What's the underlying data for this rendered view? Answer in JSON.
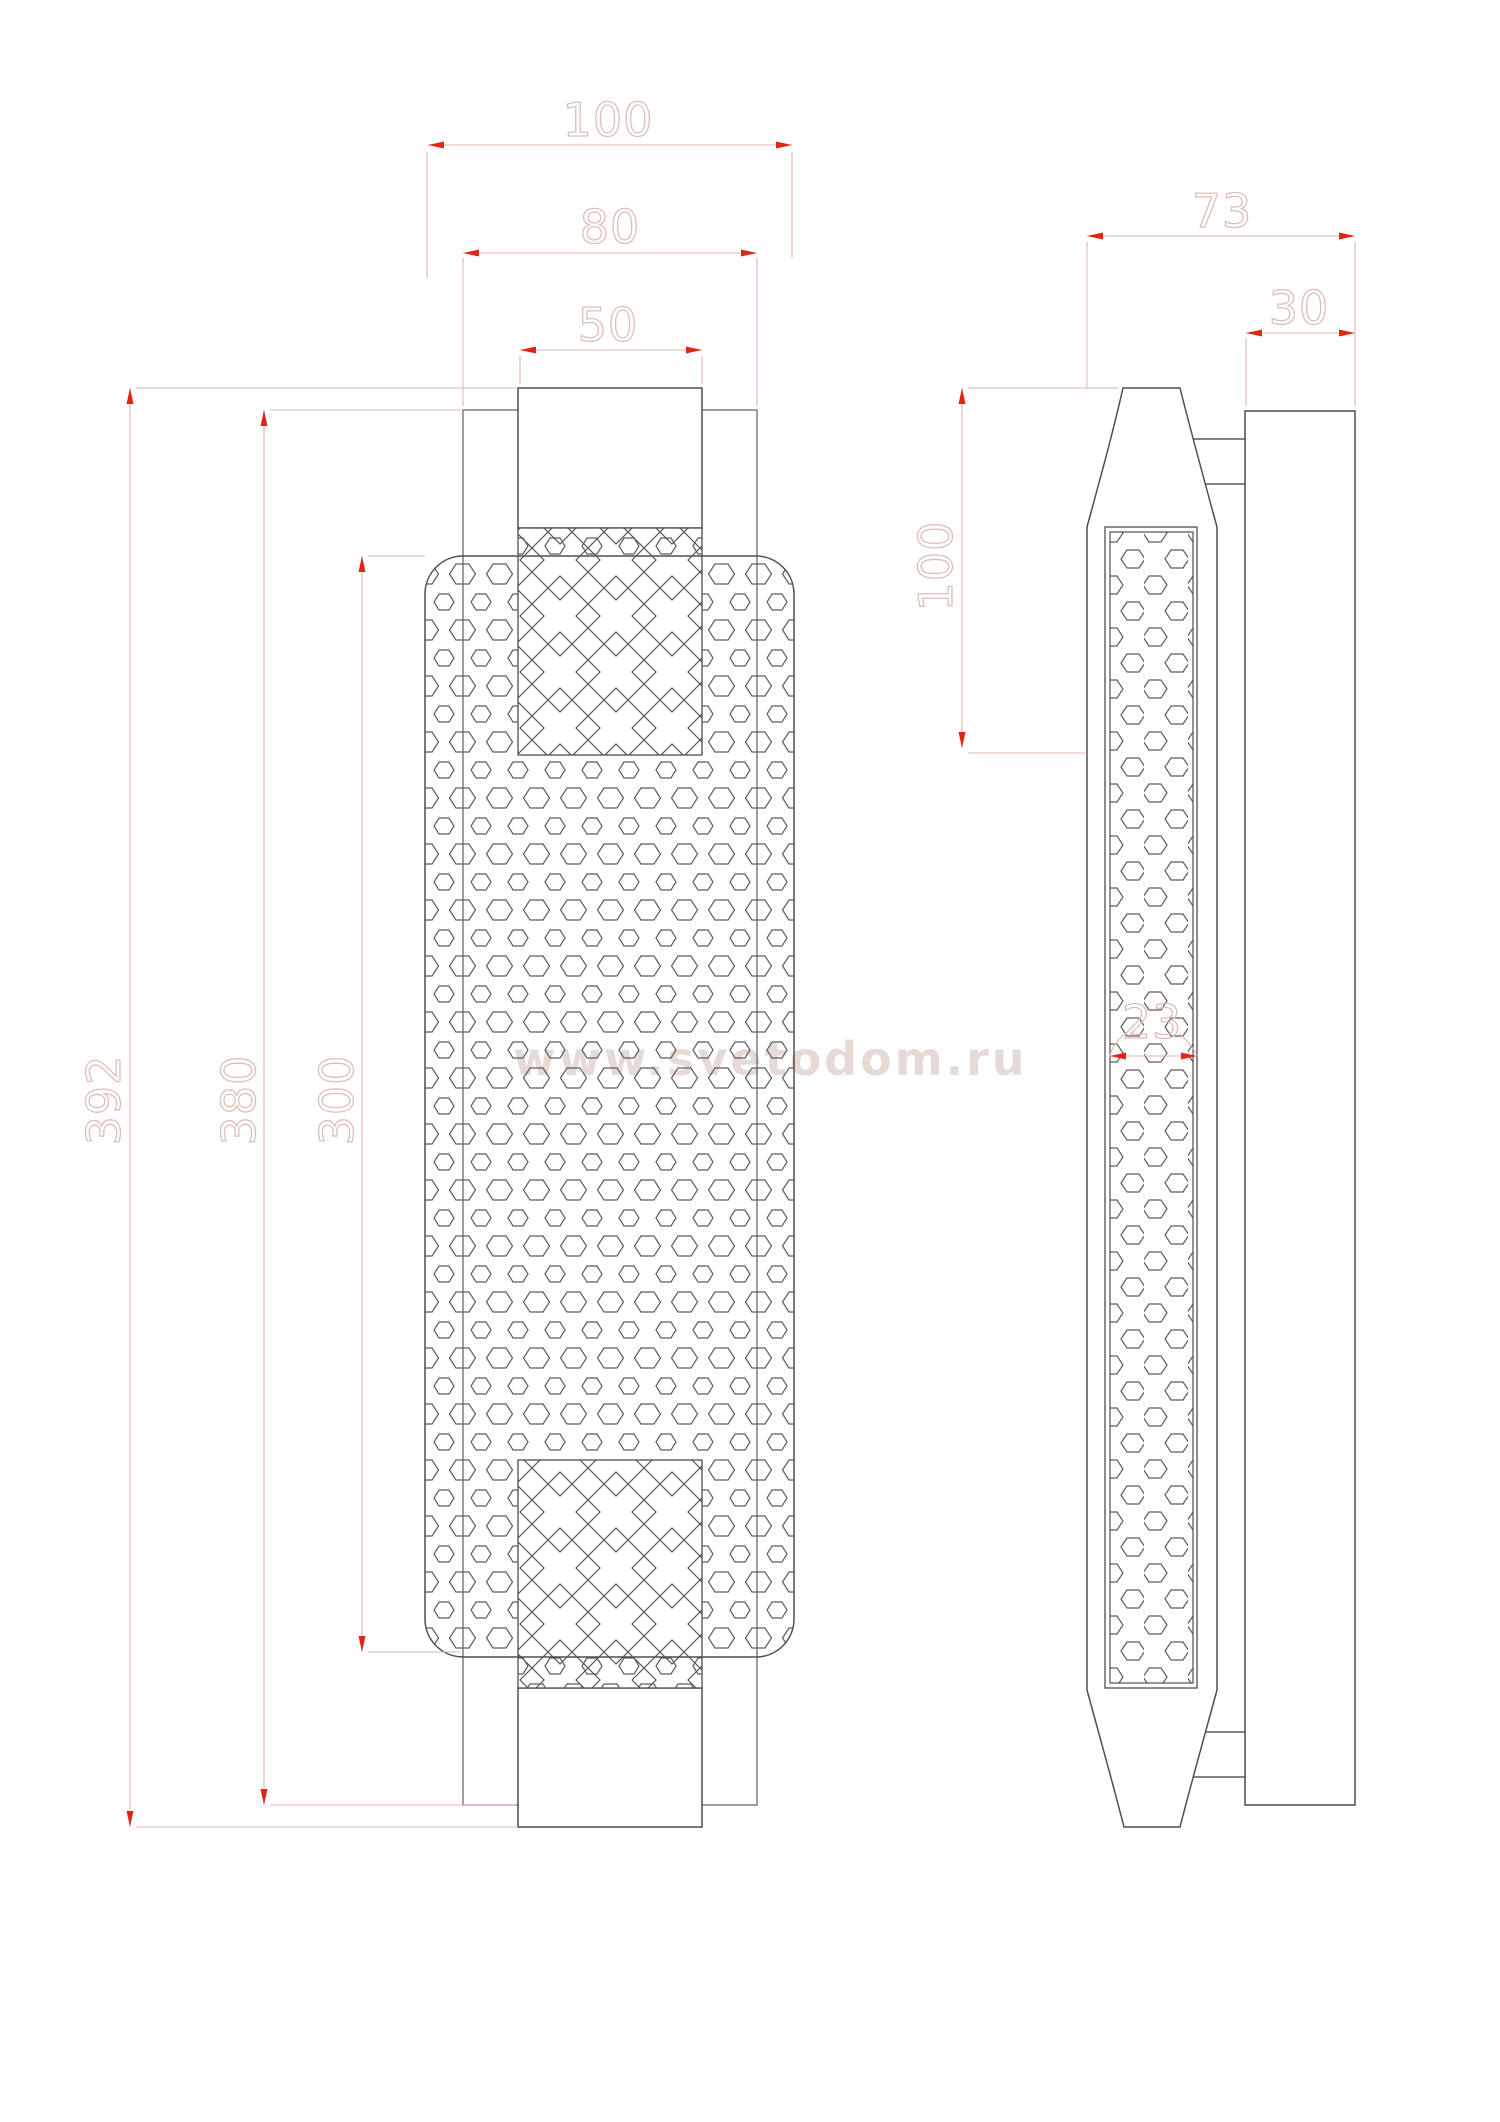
{
  "watermark": "www.svetodom.ru",
  "dimensions": {
    "front": {
      "width_overall": "100",
      "width_backplate": "80",
      "width_cap": "50",
      "height_overall": "392",
      "height_backplate": "380",
      "height_glass": "300"
    },
    "side": {
      "depth_overall": "73",
      "wallplate_depth": "30",
      "cap_height": "100",
      "tube_depth": "23"
    }
  },
  "colors": {
    "geometry_line": "#4f4f4f",
    "backplate_line": "#6a6a6a",
    "dimension_line": "#e3b6ad",
    "arrow": "#e02415",
    "dimension_text_outline": "#ddbfb7",
    "watermark_text": "#cbaca0",
    "background": "#ffffff"
  }
}
